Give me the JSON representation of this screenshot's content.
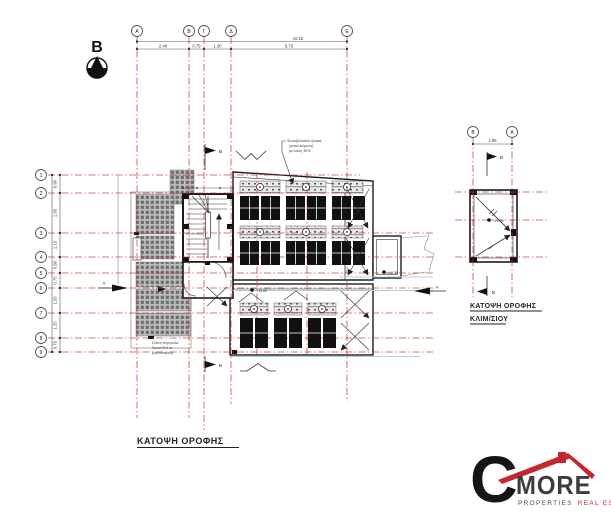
{
  "colors": {
    "grid_red": "#c0392b",
    "drawing_line": "#1c1c1c",
    "cyan_line": "#a5d5e0",
    "panel_black": "#111111",
    "logo_red": "#c4272e",
    "logo_dark": "#3d3d3d"
  },
  "north": {
    "label": "B"
  },
  "main_plan": {
    "title": "ΚΑΤΟΨΗ ΟΡΟΦΗΣ",
    "col_bubbles": [
      "Α",
      "Β",
      "Γ",
      "Δ",
      "Ε"
    ],
    "row_bubbles": [
      "1",
      "2",
      "3",
      "4",
      "5",
      "6",
      "7",
      "8",
      "9"
    ],
    "top_dim_total": "10.15",
    "top_dim_segments": [
      "2.40",
      "0.75",
      "1.30",
      "5.70"
    ],
    "left_dim_segments": [
      "0.90",
      "1.95",
      "1.15",
      "0.80",
      "0.75",
      "1.20",
      "1.20",
      "0.70"
    ],
    "pv_note": [
      "Φωτοβολταϊκά ηλιακά",
      "(ανακλινόμενα)",
      "με κλίση 30%"
    ],
    "pergola_note": [
      "ξύλινη πέργκολα",
      "δοκοί 9Χ9 εκ.",
      "(εμποτισμού)"
    ],
    "level_stair": "+10.60",
    "level_box": "+10.35",
    "section_b_top": "Β",
    "section_b_bottom": "Β",
    "section_a_left": "Α",
    "section_a_right": "Α"
  },
  "stair_plan": {
    "title_line1": "ΚΑΤΟΨΗ ΟΡΟΦΗΣ",
    "title_line2": "ΚΛΙΜ/ΣΙΟΥ",
    "col_bubbles": [
      "Β",
      "Α"
    ],
    "dim": "1.95",
    "level": "+10.95",
    "section_b_top": "Β",
    "section_b_bottom": "Β"
  },
  "logo": {
    "letter": "C",
    "name": "MORE",
    "sub_left": "PROPERTIES",
    "sub_right": "REAL ESTATES"
  }
}
